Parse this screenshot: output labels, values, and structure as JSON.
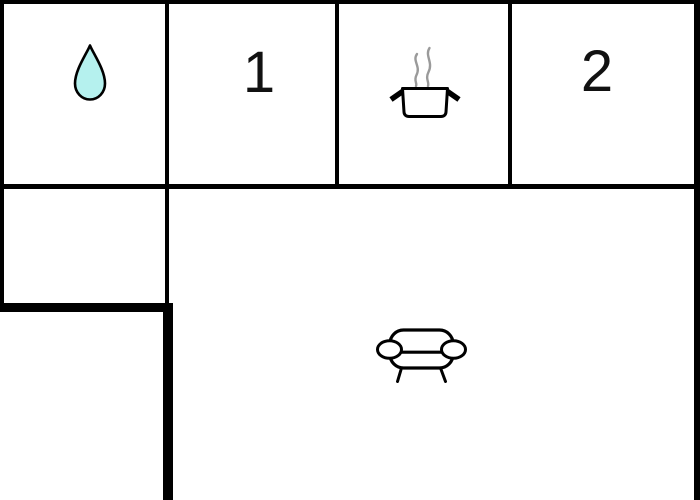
{
  "floorplan": {
    "background": "#ffffff",
    "wall_color": "#000000",
    "rooms": [
      {
        "id": "bathroom",
        "icon": "water-drop-icon",
        "label": ""
      },
      {
        "id": "room-1",
        "icon": "",
        "label": "1"
      },
      {
        "id": "kitchen",
        "icon": "cooking-pot-icon",
        "label": ""
      },
      {
        "id": "room-2",
        "icon": "",
        "label": "2"
      },
      {
        "id": "side-room",
        "icon": "",
        "label": ""
      },
      {
        "id": "living-room",
        "icon": "sofa-icon",
        "label": ""
      }
    ],
    "colors": {
      "water_drop_fill": "#b5f1ee",
      "steam_gray": "#9a9a9a",
      "label_color": "#111111"
    }
  }
}
